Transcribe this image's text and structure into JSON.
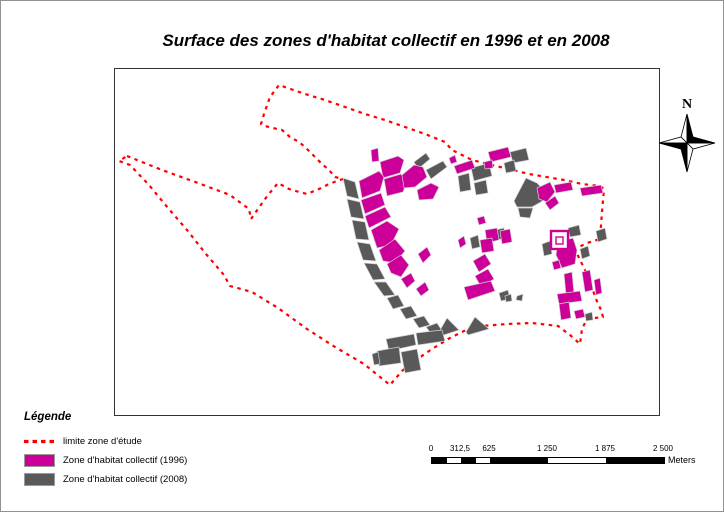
{
  "page": {
    "title": "Surface des zones d'habitat collectif en 1996 et en 2008"
  },
  "north_arrow": {
    "label": "N"
  },
  "legend": {
    "title": "Légende",
    "items": [
      {
        "label": "limite zone d'étude",
        "type": "dashed-line",
        "color": "#ff0000"
      },
      {
        "label": "Zone d'habitat collectif (1996)",
        "type": "fill",
        "color": "#cc0099"
      },
      {
        "label": "Zone d'habitat collectif (2008)",
        "type": "fill",
        "color": "#595959"
      }
    ]
  },
  "scalebar": {
    "unit_label": "Meters",
    "tick_labels": [
      {
        "pos": 0,
        "text": "0"
      },
      {
        "pos": 0.125,
        "text": "312,5"
      },
      {
        "pos": 0.25,
        "text": "625"
      },
      {
        "pos": 0.5,
        "text": "1 250"
      },
      {
        "pos": 0.75,
        "text": "1 875"
      },
      {
        "pos": 1,
        "text": "2 500"
      }
    ],
    "segments": [
      {
        "w": 0.0625,
        "color": "#000000"
      },
      {
        "w": 0.0625,
        "color": "#ffffff"
      },
      {
        "w": 0.0625,
        "color": "#000000"
      },
      {
        "w": 0.0625,
        "color": "#ffffff"
      },
      {
        "w": 0.25,
        "color": "#000000"
      },
      {
        "w": 0.25,
        "color": "#ffffff"
      },
      {
        "w": 0.25,
        "color": "#000000"
      }
    ]
  },
  "map": {
    "frame": {
      "x": 113,
      "y": 67,
      "w": 544,
      "h": 346
    },
    "boundary_color": "#ff0000",
    "zone_1996_color": "#cc0099",
    "zone_2008_color": "#595959",
    "parcel_stroke": "#d4d4d4",
    "boundary_points": "125,154 160,168 196,181 228,193 247,207 249,217 258,204 266,193 276,181 287,187 297,190 305,192 317,187 327,182 335,179 341,177 333,175 327,168 320,162 315,157 310,152 303,145 297,140 288,135 280,128 275,127 263,124 259,122 262,112 268,95 277,83 303,92 323,98 343,105 363,112 383,118 403,125 423,132 443,140 450,148 470,158 490,163 527,172 562,178 580,182 598,184 602,187 600,210 598,237 585,241 573,247 578,258 584,270 589,283 594,297 599,308 601,315 585,317 580,327 578,342 568,333 556,324 530,321 505,322 480,324 466,327 448,336 430,347 414,358 400,369 388,383 362,362 333,345 305,327 276,306 250,290 228,284 222,273 204,252 185,228 166,206 147,183 128,163 117,159",
    "zones": [
      {
        "y": "2008",
        "p": "341,176 353,180 357,197 345,194"
      },
      {
        "y": "2008",
        "p": "345,197 358,200 362,217 349,215"
      },
      {
        "y": "2008",
        "p": "350,218 363,220 367,238 354,237"
      },
      {
        "y": "2008",
        "p": "355,240 368,242 374,259 361,258"
      },
      {
        "y": "2008",
        "p": "362,261 375,262 383,277 371,278"
      },
      {
        "y": "2008",
        "p": "372,280 384,280 393,293 382,294"
      },
      {
        "y": "2008",
        "p": "385,296 396,293 402,304 391,307"
      },
      {
        "y": "2008",
        "p": "398,307 409,304 415,314 404,317"
      },
      {
        "y": "2008",
        "p": "411,317 422,314 428,323 417,326"
      },
      {
        "y": "2008",
        "p": "424,325 435,321 441,330 430,333"
      },
      {
        "y": "2008",
        "p": "437,330 445,316 457,328 439,334"
      },
      {
        "y": "2008",
        "p": "464,330 473,315 487,327 466,333"
      },
      {
        "y": "2008",
        "p": "412,160 424,151 428,157 416,167"
      },
      {
        "y": "2008",
        "p": "424,168 441,159 445,165 429,177"
      },
      {
        "y": "2008",
        "p": "469,166 487,161 490,174 472,179"
      },
      {
        "y": "2008",
        "p": "456,174 467,171 469,188 458,190"
      },
      {
        "y": "2008",
        "p": "472,181 484,178 486,191 474,193"
      },
      {
        "y": "2008",
        "p": "512,199 524,176 535,181 543,189 544,197 530,205 515,205"
      },
      {
        "y": "2008",
        "p": "516,206 531,206 528,216 518,215"
      },
      {
        "y": "2008",
        "p": "493,228 502,226 504,236 495,238"
      },
      {
        "y": "2008",
        "p": "468,236 476,233 478,245 470,247"
      },
      {
        "y": "2008",
        "p": "497,291 506,288 508,297 499,299"
      },
      {
        "y": "2008",
        "p": "515,294 521,292 520,299 514,298"
      },
      {
        "y": "2008",
        "p": "503,294 509,292 510,299 504,300"
      },
      {
        "y": "2008",
        "p": "540,242 548,239 550,252 542,254"
      },
      {
        "y": "2008",
        "p": "566,226 577,223 579,233 568,235"
      },
      {
        "y": "2008",
        "p": "578,247 586,244 588,254 580,257"
      },
      {
        "y": "2008",
        "p": "594,229 603,226 605,237 596,240"
      },
      {
        "y": "2008",
        "p": "384,337 412,332 414,343 387,349"
      },
      {
        "y": "2008",
        "p": "414,331 440,328 443,339 416,343"
      },
      {
        "y": "2008",
        "p": "399,350 415,347 419,368 403,371"
      },
      {
        "y": "2008",
        "p": "375,349 397,345 399,361 377,364"
      },
      {
        "y": "2008",
        "p": "370,352 376,350 378,362 372,363"
      },
      {
        "y": "2008",
        "p": "508,150 524,146 527,158 511,161"
      },
      {
        "y": "2008",
        "p": "502,161 512,158 514,169 504,171"
      },
      {
        "y": "2008",
        "p": "583,312 590,310 591,318 584,319"
      },
      {
        "y": "1996",
        "p": "369,148 376,146 377,159 370,160"
      },
      {
        "y": "1996",
        "p": "378,160 396,154 402,158 398,171 381,176"
      },
      {
        "y": "1996",
        "p": "357,179 377,169 382,175 378,189 360,196"
      },
      {
        "y": "1996",
        "p": "359,198 379,191 383,203 363,212"
      },
      {
        "y": "1996",
        "p": "363,214 383,205 389,215 367,226"
      },
      {
        "y": "1996",
        "p": "382,177 399,172 405,180 401,190 385,194"
      },
      {
        "y": "1996",
        "p": "400,173 412,163 421,165 425,175 413,185 402,186"
      },
      {
        "y": "1996",
        "p": "415,188 429,181 437,185 431,197 417,198"
      },
      {
        "y": "1996",
        "p": "369,228 385,219 397,227 389,243 375,246"
      },
      {
        "y": "1996",
        "p": "377,248 393,237 403,249 393,261 381,259"
      },
      {
        "y": "1996",
        "p": "385,262 399,253 407,263 399,275 389,271"
      },
      {
        "y": "1996",
        "p": "399,277 409,271 413,279 405,286"
      },
      {
        "y": "1996",
        "p": "416,252 425,245 429,253 421,261"
      },
      {
        "y": "1996",
        "p": "414,287 423,280 427,288 419,294"
      },
      {
        "y": "1996",
        "p": "452,164 470,158 473,166 455,172"
      },
      {
        "y": "1996",
        "p": "447,156 453,153 455,160 449,162"
      },
      {
        "y": "1996",
        "p": "486,150 506,145 509,155 489,160"
      },
      {
        "y": "1996",
        "p": "482,160 490,158 491,166 483,167"
      },
      {
        "y": "1996",
        "p": "535,186 548,180 553,190 545,200 537,197"
      },
      {
        "y": "1996",
        "p": "543,201 553,194 557,201 548,208"
      },
      {
        "y": "1996",
        "p": "483,228 495,226 497,238 485,241"
      },
      {
        "y": "1996",
        "p": "498,229 508,227 510,240 500,242"
      },
      {
        "y": "1996",
        "p": "478,238 490,236 492,249 480,251"
      },
      {
        "y": "1996",
        "p": "475,216 482,214 484,221 477,223"
      },
      {
        "y": "1996",
        "p": "456,238 462,234 464,242 458,246"
      },
      {
        "y": "1996",
        "p": "471,259 483,252 489,262 477,270"
      },
      {
        "y": "1996",
        "p": "473,274 486,267 492,277 479,285"
      },
      {
        "y": "1996",
        "p": "462,285 489,279 493,289 466,298"
      },
      {
        "y": "1996",
        "p": "552,183 569,180 571,188 554,191"
      },
      {
        "y": "1996",
        "p": "578,186 599,183 601,191 580,194"
      },
      {
        "y": "1996",
        "p": "556,240 571,236 575,248 573,262 560,266 554,253"
      },
      {
        "y": "1996",
        "p": "562,272 570,270 572,291 564,293"
      },
      {
        "y": "1996",
        "p": "555,292 578,289 580,299 557,302"
      },
      {
        "y": "1996",
        "p": "580,270 588,268 591,288 583,290"
      },
      {
        "y": "1996",
        "p": "592,278 598,276 600,291 594,293"
      },
      {
        "y": "1996",
        "p": "550,260 557,258 559,266 552,268"
      },
      {
        "y": "1996",
        "p": "557,302 567,300 569,316 559,318"
      },
      {
        "y": "1996",
        "p": "572,309 581,307 583,315 574,317"
      }
    ],
    "house_outline": {
      "outer": {
        "x": 549,
        "y": 229,
        "w": 17,
        "h": 18
      },
      "inner": {
        "x": 554,
        "y": 235,
        "w": 7,
        "h": 7
      }
    }
  }
}
